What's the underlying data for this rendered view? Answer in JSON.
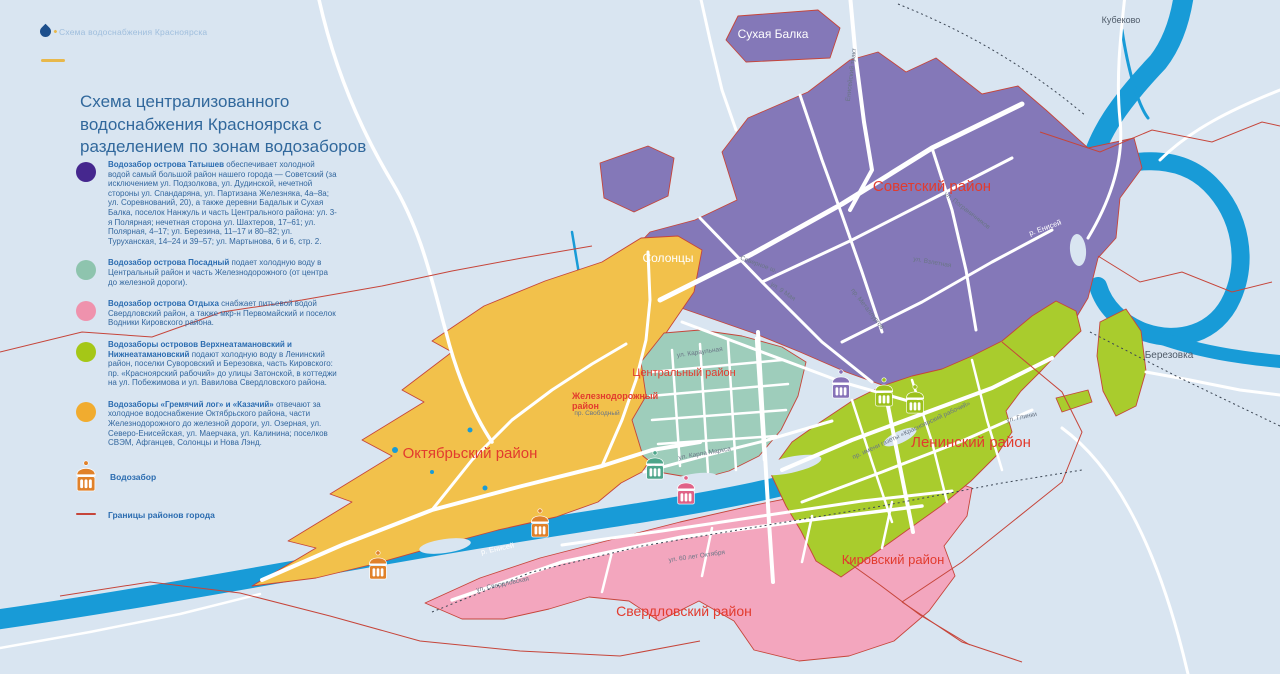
{
  "header": {
    "logo_text": "Схема водоснабжения Красноярска",
    "title": "Схема централизованного водоснабжения Красноярска с разделением по зонам водозаборов"
  },
  "legend": {
    "items": [
      {
        "color": "#45278e",
        "lead": "Водозабор острова Татышев",
        "text": "обеспечивает холодной водой самый большой район нашего города — Советский (за исключением ул. Подзолкова, ул. Дудинской, нечетной стороны ул. Спандаряна, ул. Партизана Железняка, 4а–8а; ул. Соревнований, 20), а также деревни Бадалык и Сухая Балка, поселок Нанжуль и часть Центрального района: ул. 3-я Полярная; нечетная сторона ул. Шахтеров, 17–61; ул. Полярная, 4–17; ул. Березина, 11–17 и 80–82; ул. Туруханская, 14–24 и 39–57; ул. Мартынова, 6 и 6, стр. 2."
      },
      {
        "color": "#8ec4ae",
        "lead": "Водозабор острова Посадный",
        "text": "подает холодную воду в Центральный район и часть Железнодорожного (от центра до железной дороги)."
      },
      {
        "color": "#ef92ad",
        "lead": "Водозабор острова Отдыха",
        "text": "снабжает питьевой водой Свердловский район, а также мкр-н Первомайский и поселок Водники Кировского района."
      },
      {
        "color": "#a5c717",
        "lead": "Водозаборы островов Верхнеатамановский и Нижнеатамановский",
        "text": "подают холодную воду в Ленинский район, поселки Суворовский и Березовка, часть Кировского: пр. «Красноярский рабочий» до улицы Затонской, в коттеджи на ул. Побежимова и ул. Вавилова Свердловского района."
      },
      {
        "color": "#f1ac2f",
        "lead": "Водозаборы «Гремячий лог» и «Казачий»",
        "text": "отвечают за холодное водоснабжение Октябрьского района, части Железнодорожного до железной дороги, ул. Озерная, ул. Северо-Енисейская, ул. Маерчака, ул. Калинина; поселков СВЭМ, Афганцев, Солонцы и Нова Лэнд."
      }
    ],
    "tower_label": "Водозабор",
    "tower_color": "#e0812a",
    "boundary_label": "Границы районов города"
  },
  "map": {
    "colors": {
      "background": "#d9e5f1",
      "river": "#189bd7",
      "zone_soviet": "#8478b8",
      "zone_october": "#f2c14b",
      "zone_central": "#9ecdbb",
      "zone_sverdlovsk": "#f3a6be",
      "zone_leninsky": "#a9cc2d",
      "road": "#ffffff",
      "boundary": "#c6453a",
      "railway": "#3c4654",
      "district_label": "#e23b2e"
    },
    "districts": [
      {
        "name": "Советский район",
        "x": 932,
        "y": 191,
        "size": 15
      },
      {
        "name": "Октябрьский район",
        "x": 470,
        "y": 458,
        "size": 15
      },
      {
        "name": "Ленинский район",
        "x": 971,
        "y": 447,
        "size": 15
      },
      {
        "name": "Кировский район",
        "x": 893,
        "y": 564,
        "size": 13
      },
      {
        "name": "Свердловский район",
        "x": 684,
        "y": 616,
        "size": 14
      },
      {
        "name": "Центральный район",
        "x": 684,
        "y": 376,
        "size": 11
      },
      {
        "name": "Железнодорожный",
        "x": 572,
        "y": 399,
        "size": 9,
        "anchor": "start",
        "bold": true
      },
      {
        "name": "район",
        "x": 572,
        "y": 409,
        "size": 9,
        "anchor": "start",
        "bold": true
      }
    ],
    "places": [
      {
        "name": "Сухая Балка",
        "x": 773,
        "y": 38,
        "size": 12,
        "kind": "white"
      },
      {
        "name": "Солонцы",
        "x": 668,
        "y": 262,
        "size": 12,
        "kind": "white"
      },
      {
        "name": "Кубеково",
        "x": 1121,
        "y": 23,
        "size": 9,
        "kind": "gray"
      },
      {
        "name": "Березовка",
        "x": 1169,
        "y": 358,
        "size": 10,
        "kind": "gray"
      }
    ],
    "streets": [
      {
        "t": "Енисейский тракт",
        "x": 853,
        "y": 75,
        "r": -83
      },
      {
        "t": "Северное ш.",
        "x": 758,
        "y": 266,
        "r": 20
      },
      {
        "t": "ул. 9 Мая",
        "x": 782,
        "y": 293,
        "r": 34
      },
      {
        "t": "пр. Металлургов",
        "x": 866,
        "y": 310,
        "r": 52
      },
      {
        "t": "ул. Взлетная",
        "x": 932,
        "y": 264,
        "r": 10
      },
      {
        "t": "ул. Пограничников",
        "x": 966,
        "y": 212,
        "r": 38
      },
      {
        "t": "ул. Караульная",
        "x": 700,
        "y": 354,
        "r": -8
      },
      {
        "t": "пр. Свободный",
        "x": 597,
        "y": 415,
        "r": 0
      },
      {
        "t": "ул. Карла Маркса",
        "x": 705,
        "y": 455,
        "r": -10
      },
      {
        "t": "ул. Свердловская",
        "x": 503,
        "y": 586,
        "r": -12
      },
      {
        "t": "ул. 60 лет Октября",
        "x": 697,
        "y": 558,
        "r": -8
      },
      {
        "t": "пр. имени газеты «Красноярский рабочий»",
        "x": 912,
        "y": 432,
        "r": -25
      },
      {
        "t": "ул. Глинки",
        "x": 1022,
        "y": 419,
        "r": -12
      }
    ],
    "river_labels": [
      {
        "t": "р. Енисей",
        "x": 1046,
        "y": 230,
        "r": -20
      },
      {
        "t": "р. Енисей",
        "x": 498,
        "y": 551,
        "r": -12
      }
    ],
    "towers": [
      {
        "x": 378,
        "y": 566,
        "color": "#e0812a"
      },
      {
        "x": 540,
        "y": 524,
        "color": "#e0812a"
      },
      {
        "x": 655,
        "y": 466,
        "color": "#4da58a"
      },
      {
        "x": 686,
        "y": 491,
        "color": "#e06287"
      },
      {
        "x": 841,
        "y": 385,
        "color": "#8672b8"
      },
      {
        "x": 884,
        "y": 393,
        "color": "#9cc11c"
      },
      {
        "x": 915,
        "y": 400,
        "color": "#9cc11c"
      }
    ]
  }
}
